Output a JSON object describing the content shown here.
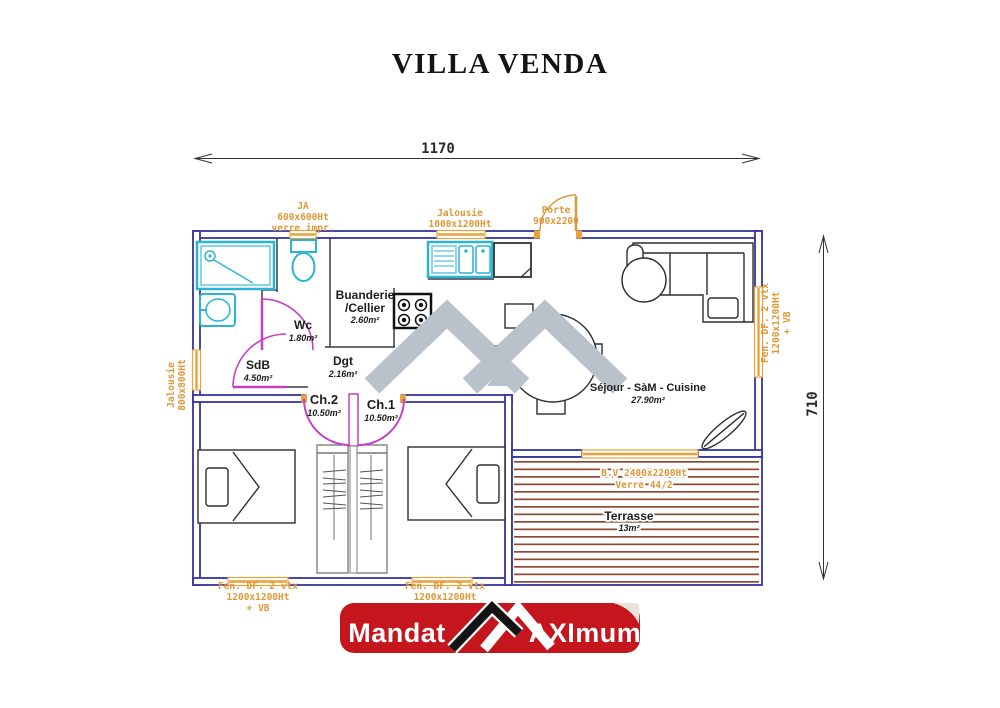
{
  "page": {
    "title": "VILLA VENDA"
  },
  "dimensions": {
    "width": "1170",
    "height": "710"
  },
  "openings": {
    "ja_top": {
      "l1": "JA",
      "l2": "600x600Ht",
      "l3": "verre impr."
    },
    "jalousie_top": {
      "l1": "Jalousie",
      "l2": "1000x1200Ht"
    },
    "porte": {
      "l1": "Porte",
      "l2": "900x2200"
    },
    "jalousie_left": {
      "l1": "Jalousie",
      "l2": "800x800Ht"
    },
    "fen_right": {
      "l1": "Fen. DF. 2 vtx",
      "l2": "1200x1200Ht",
      "l3": "+ VB"
    },
    "fen_bottom_left": {
      "l1": "Fen. DF. 2 vtx",
      "l2": "1200x1200Ht",
      "l3": "+ VB"
    },
    "fen_bottom_right": {
      "l1": "Fen. DF. 2 vtx",
      "l2": "1200x1200Ht"
    },
    "baie_vitree": {
      "l1": "B.V 2400x2200Ht",
      "l2": "Verre 44/2"
    }
  },
  "rooms": {
    "wc": {
      "name": "Wc",
      "area": "1.80m²"
    },
    "sdb": {
      "name": "SdB",
      "area": "4.50m²"
    },
    "buanderie": {
      "name": "Buanderie",
      "name2": "/Cellier",
      "area": "2.60m²"
    },
    "dgt": {
      "name": "Dgt",
      "area": "2.16m²"
    },
    "ch2": {
      "name": "Ch.2",
      "area": "10.50m²"
    },
    "ch1": {
      "name": "Ch.1",
      "area": "10.50m²"
    },
    "sejour": {
      "name": "Séjour - SàM - Cuisine",
      "area": "27.90m²"
    },
    "terrasse": {
      "name": "Terrasse",
      "area": "13m²"
    }
  },
  "banner": {
    "left": "Mandat",
    "right": "AXImum"
  },
  "colors": {
    "wall": "#3434a3",
    "opening": "#dd9838",
    "door": "#c540c5",
    "fixture": "#2ab5d6",
    "terrace_deck": "#8d4b33",
    "watermark": "#b9c1cb",
    "banner_red": "#c4161c"
  }
}
